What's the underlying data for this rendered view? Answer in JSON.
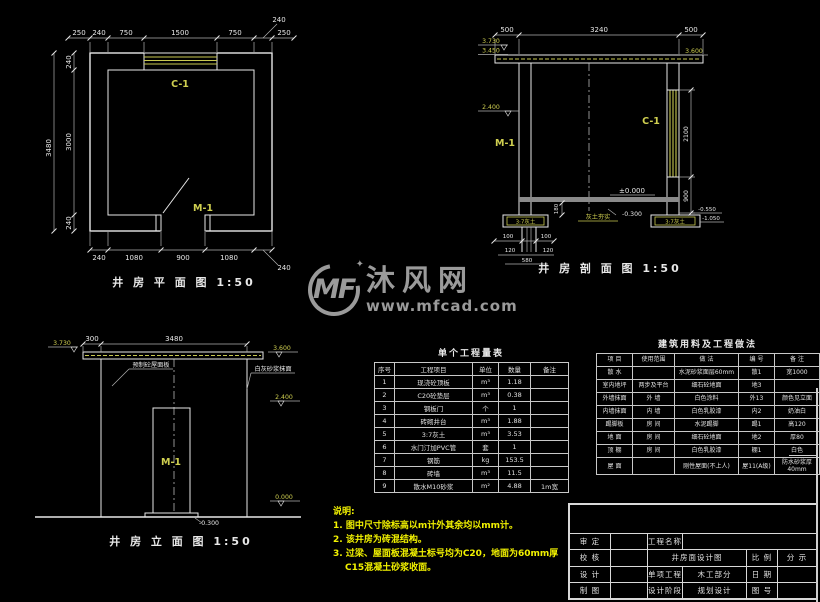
{
  "plan": {
    "title": "井 房 平 面 图 1:50",
    "window_label": "C-1",
    "door_label": "M-1",
    "dims_top": [
      "250",
      "240",
      "750",
      "1500",
      "750",
      "240",
      "250"
    ],
    "dim_left_outer": "3480",
    "dims_left": [
      "240",
      "3000",
      "240"
    ],
    "dims_bottom": [
      "240",
      "1080",
      "900",
      "1080",
      "240"
    ]
  },
  "section": {
    "title": "井 房 剖 面 图 1:50",
    "dims_top": [
      "500",
      "3240",
      "500"
    ],
    "levels_left": [
      "3.730",
      "3.450",
      "2.400"
    ],
    "level_right_top": "3.600",
    "dims_right": [
      "2100",
      "900"
    ],
    "level_zero": "±0.000",
    "level_neg": "-0.300",
    "levels_bottom_right": [
      "-0.550",
      "-1.050"
    ],
    "dim_footing_height": "180",
    "dims_footing": [
      "100",
      "100",
      "120",
      "120",
      "580"
    ],
    "hatch_label_left": "3:7灰土",
    "hatch_label_right": "3:7灰土",
    "hatch_label_center": "灰土夯实",
    "door_label": "M-1",
    "window_label": "C-1"
  },
  "elevation": {
    "title": "井 房 立 面 图 1:50",
    "dims_top": [
      "300",
      "3480"
    ],
    "level_top_left": "3.730",
    "level_top_right": "3.600",
    "level_right": "2.400",
    "level_zero": "0.000",
    "level_neg": "-0.300",
    "door_label": "M-1",
    "note_left": "预制砼屋面板",
    "note_right": "白灰砂浆抹面"
  },
  "watermark": {
    "logo": "MF",
    "star": "✦",
    "name": "沐风网",
    "url": "www.mfcad.com"
  },
  "quantity_table": {
    "title": "单个工程量表",
    "headers": [
      "序号",
      "工程项目",
      "单位",
      "数量",
      "备注"
    ],
    "rows": [
      [
        "1",
        "现浇砼顶板",
        "m³",
        "1.18",
        ""
      ],
      [
        "2",
        "C20砼垫层",
        "m³",
        "0.38",
        ""
      ],
      [
        "3",
        "钢板门",
        "个",
        "1",
        ""
      ],
      [
        "4",
        "砖砌井台",
        "m³",
        "1.88",
        ""
      ],
      [
        "5",
        "3:7灰土",
        "m³",
        "3.53",
        ""
      ],
      [
        "6",
        "水门汀加PVC管",
        "套",
        "1",
        ""
      ],
      [
        "7",
        "钢筋",
        "kg",
        "153.5",
        ""
      ],
      [
        "8",
        "砖墙",
        "m³",
        "11.5",
        ""
      ],
      [
        "9",
        "散水M10砂浆",
        "m²",
        "4.88",
        "1m宽"
      ]
    ]
  },
  "materials_table": {
    "title": "建筑用料及工程做法",
    "headers": [
      "项 目",
      "使用范围",
      "做 法",
      "编 号",
      "备 注"
    ],
    "rows": [
      [
        "散 水",
        "",
        "水泥砂浆面层60mm",
        "散1",
        "宽1000"
      ],
      [
        "室内地坪",
        "两步及平台",
        "细石砼地面",
        "地3",
        ""
      ],
      [
        "外墙抹面",
        "外 墙",
        "白色涂料",
        "外13",
        "颜色见立面"
      ],
      [
        "内墙抹面",
        "内 墙",
        "白色乳胶漆",
        "内2",
        "奶油白"
      ],
      [
        "踢脚板",
        "房 间",
        "水泥踢脚",
        "踢1",
        "高120"
      ],
      [
        "地 面",
        "房 间",
        "细石砼地面",
        "地2",
        "厚80"
      ],
      [
        "顶 棚",
        "房 间",
        "白色乳胶漆",
        "棚1",
        "白色"
      ],
      [
        "屋 面",
        "",
        "刚性屋面(不上人)",
        "屋11(A级)",
        "防水砂浆厚40mm"
      ]
    ]
  },
  "notes": {
    "heading": "说明:",
    "items": [
      "1. 图中尺寸除标高以m计外其余均以mm计。",
      "2. 该井房为砖混结构。",
      "3. 过梁、屋面板混凝土标号均为C20，地面为60mm厚C15混凝土砂浆收面。"
    ]
  },
  "title_block": {
    "shending": "审 定",
    "gongcheng_mingcheng": "工程名称",
    "jiaohe": "校 核",
    "drawing_name": "井房面设计图",
    "bili": "比 例",
    "fenshi": "分 示",
    "sheji": "设 计",
    "danxiang": "单项工程",
    "mugong": "木工部分",
    "riqi": "日 期",
    "zhitu": "制 图",
    "jieduan": "设计阶段",
    "guihua": "规划设计",
    "tuhao": "图 号"
  }
}
